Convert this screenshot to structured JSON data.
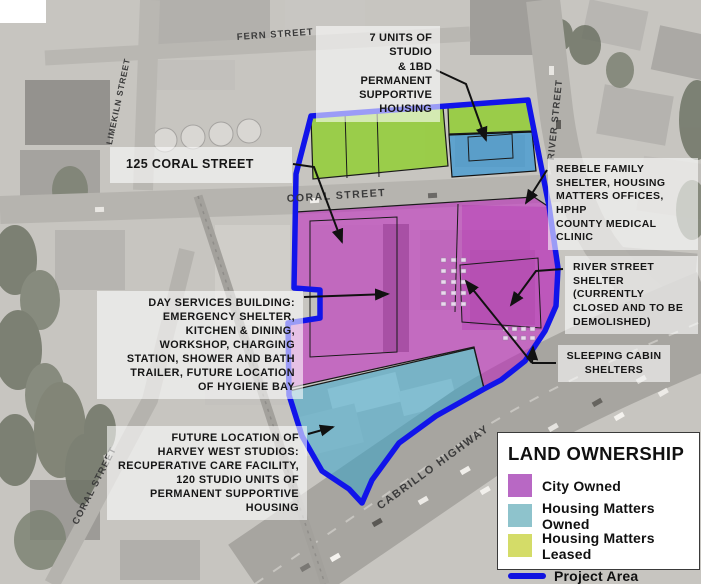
{
  "streets": {
    "fern": "FERN STREET",
    "limekiln": "LIMEKILN STREET",
    "river": "RIVER STREET",
    "coral_main": "CORAL STREET",
    "coral_lower": "CORAL STREET",
    "cabrillo": "CABRILLO HIGHWAY"
  },
  "callouts": {
    "seven_units": {
      "text": "7 UNITS OF STUDIO\n& 1BD PERMANENT\nSUPPORTIVE\nHOUSING"
    },
    "coral_125": {
      "text": "125 CORAL STREET"
    },
    "rebele": {
      "text": "REBELE FAMILY\nSHELTER, HOUSING\nMATTERS OFFICES, HPHP\nCOUNTY MEDICAL CLINIC"
    },
    "river_shelter": {
      "text": "RIVER STREET\nSHELTER (CURRENTLY\nCLOSED AND TO BE\nDEMOLISHED)"
    },
    "sleeping_cabins": {
      "text": "SLEEPING CABIN\nSHELTERS"
    },
    "day_services": {
      "text": "DAY SERVICES BUILDING:\nEMERGENCY SHELTER,\nKITCHEN & DINING,\nWORKSHOP, CHARGING\nSTATION, SHOWER AND BATH\nTRAILER, FUTURE LOCATION\nOF HYGIENE BAY"
    },
    "harvey_west": {
      "text": "FUTURE LOCATION OF\nHARVEY WEST STUDIOS:\nRECUPERATIVE CARE FACILITY,\n120 STUDIO UNITS OF\nPERMANENT SUPPORTIVE\nHOUSING"
    }
  },
  "legend": {
    "title": "LAND OWNERSHIP",
    "items": [
      {
        "label": "City Owned",
        "color": "#b868c4",
        "type": "swatch"
      },
      {
        "label": "Housing Matters Owned",
        "color": "#8ec3cc",
        "type": "swatch"
      },
      {
        "label": "Housing Matters Leased",
        "color": "#d4dc68",
        "type": "swatch"
      },
      {
        "label": "Project Area",
        "color": "#1113e0",
        "type": "line"
      }
    ]
  },
  "map_colors": {
    "city_owned_overlay": "#c018c0",
    "housing_matters_owned_overlay": "#2fa3cc",
    "housing_matters_leased_overlay": "#7ed000",
    "project_area_outline": "#1114ea"
  }
}
